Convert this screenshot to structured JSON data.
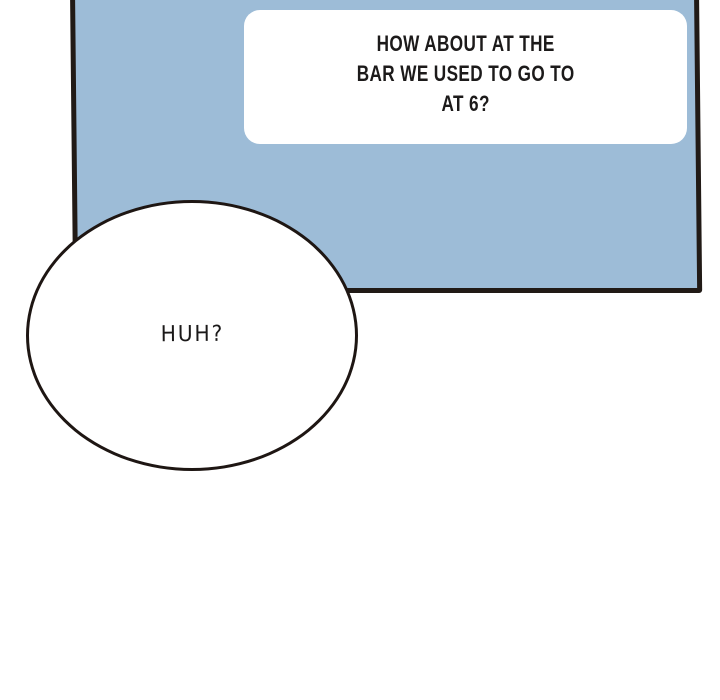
{
  "comic": {
    "panel": {
      "fill_color": "#9dbcd7",
      "border_color": "#211a16"
    },
    "dialogue_bubble": {
      "shape": "rounded-rectangle",
      "fill_color": "#ffffff",
      "text_color": "#1c1a1a",
      "lines": [
        "HOW ABOUT AT THE",
        "BAR WE USED TO GO TO",
        "AT 6?"
      ],
      "full_text": "HOW ABOUT AT THE BAR WE USED TO GO TO AT 6?"
    },
    "reply_bubble": {
      "shape": "ellipse",
      "fill_color": "#ffffff",
      "border_color": "#1e1613",
      "text_color": "#1b1919",
      "text": "HUH?"
    }
  }
}
